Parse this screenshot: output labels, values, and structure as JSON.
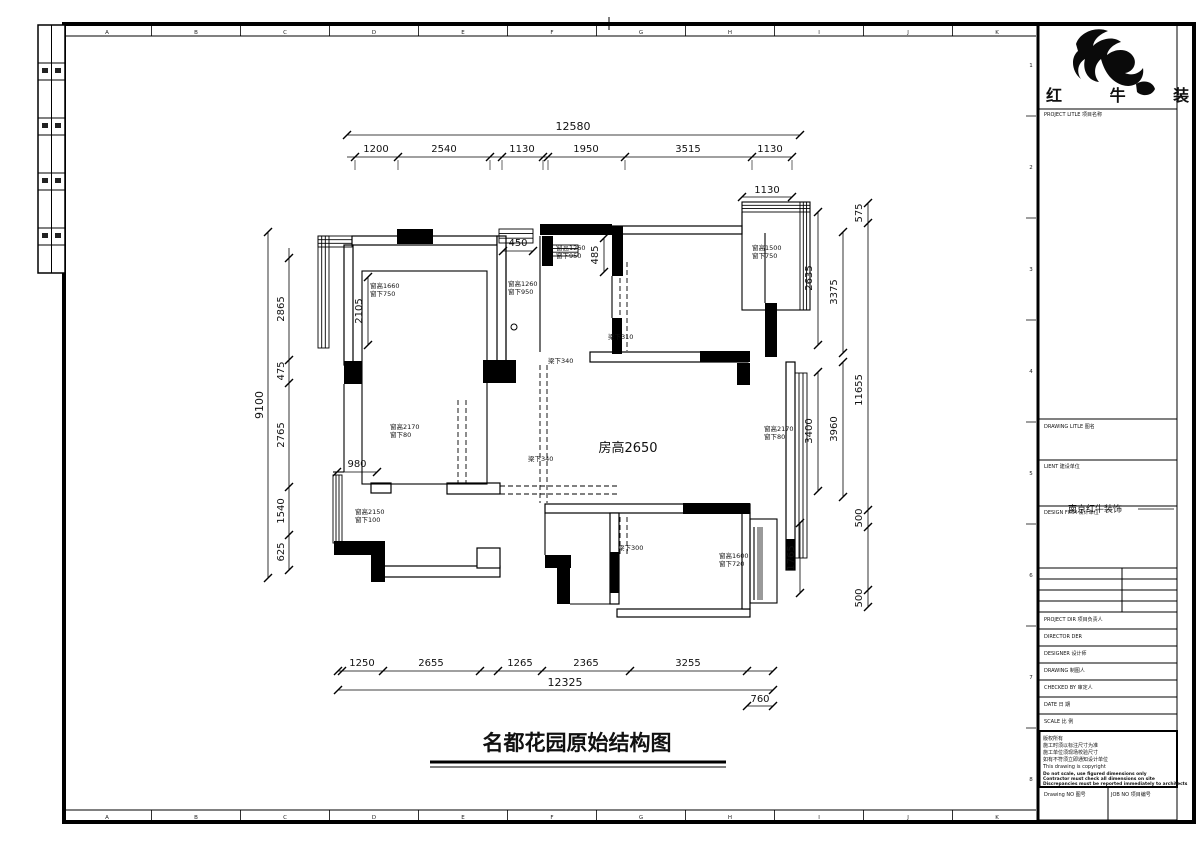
{
  "sheet": {
    "grid_letters": [
      "A",
      "B",
      "C",
      "D",
      "E",
      "F",
      "G",
      "H",
      "I",
      "J",
      "K"
    ],
    "grid_numbers": [
      "1",
      "2",
      "3",
      "4",
      "5",
      "6",
      "7",
      "8"
    ]
  },
  "drawing": {
    "footer_title": "名都花园原始结构图",
    "room_height_label": "房高2650",
    "dims": {
      "top_total": "12580",
      "top": [
        "1200",
        "2540",
        "1130",
        "1950",
        "3515",
        "1130"
      ],
      "balcony_top": "1130",
      "left_total": "9100",
      "left": [
        "2865",
        "475",
        "2765",
        "1540",
        "625"
      ],
      "a_height": "2105",
      "niche": "980",
      "mid": [
        "450",
        "485"
      ],
      "right": [
        "2635",
        "3375",
        "3400",
        "3960",
        "1765",
        "575",
        "11655",
        "500",
        "500"
      ],
      "bottom": [
        "1250",
        "2655",
        "1265",
        "2365",
        "3255"
      ],
      "bottom_total": "12325",
      "balcony_bottom": "760"
    },
    "windows": [
      {
        "h": "窗高1660",
        "s": "窗下750"
      },
      {
        "h": "窗高1260",
        "s": "窗下950"
      },
      {
        "h": "窗高1260",
        "s": "窗下950"
      },
      {
        "h": "窗高1500",
        "s": "窗下750"
      },
      {
        "h": "窗高2170",
        "s": "窗下80"
      },
      {
        "h": "窗高2170",
        "s": "窗下80"
      },
      {
        "h": "窗高2150",
        "s": "窗下100"
      },
      {
        "h": "窗高1600",
        "s": "窗下720"
      }
    ],
    "beams": [
      "梁下310",
      "梁下340",
      "梁下340",
      "梁下300"
    ]
  },
  "title_block": {
    "brand": "红 牛 装 饰",
    "project_title_label": "PROJECT LITLE  项目名称",
    "drawing_title_label": "DRAWING LITLE  图名",
    "client_label": "LIENT  建设单位",
    "client_value": "南京红牛装饰",
    "design_firm_label": "DESIGN FIRM  设计单位",
    "rows": [
      "PROJECT DIR   项目负责人",
      "DIRECTOR DER",
      "DESIGNER   设计师",
      "DRAWING   制图人",
      "CHECKED BY   审定人",
      "DATE   日 期",
      "SCALE   比 例"
    ],
    "notes": [
      "版权所有",
      "施工时须以标注尺寸为准",
      "施工单位须现场校验尺寸",
      "如有不符须立即通知设计单位",
      "This drawing is copyright"
    ],
    "notes_bold": [
      "Do not scale, use figured dimensions only",
      "Contractor must check all dimensions on site",
      "Discrepancies must be reported immediately to architects"
    ],
    "drawing_no_label": "Drawing NO  图号",
    "job_no_label": "JOB NO  项目编号"
  }
}
